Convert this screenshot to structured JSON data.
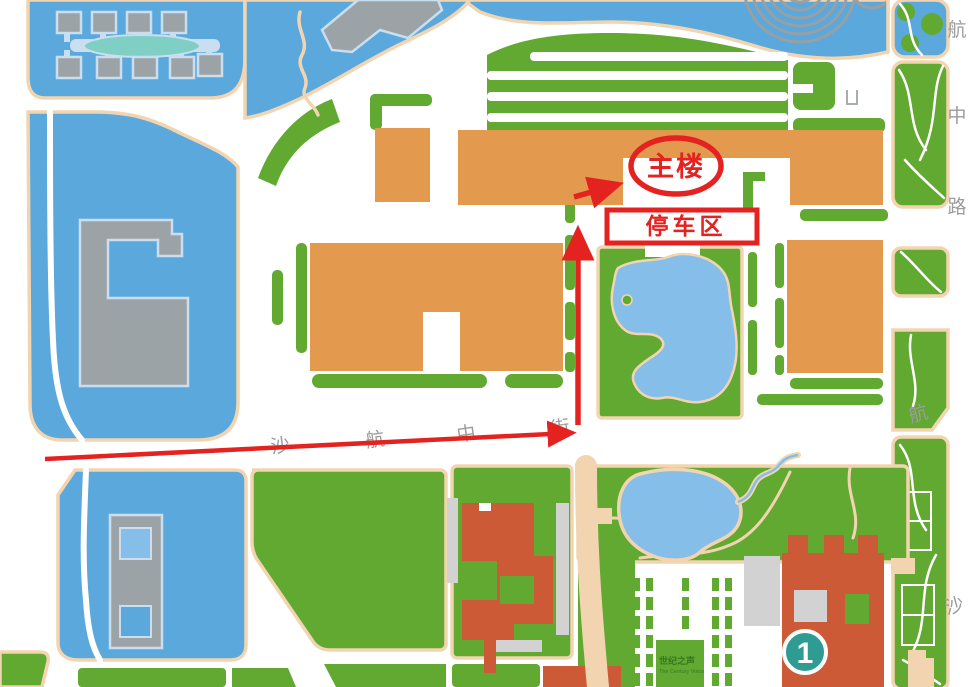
{
  "map": {
    "annotations": {
      "main_building_label": "主楼",
      "parking_area_label": "停车区"
    },
    "road_labels": {
      "shahang_middle_street": [
        "沙",
        "航",
        "中",
        "街"
      ],
      "hangzhong_road": [
        "航",
        "中",
        "路"
      ],
      "southeast_road": [
        "航",
        "沙"
      ]
    },
    "building_marker": "1",
    "watermark": {
      "title": "世纪之声",
      "subtitle": "The Century Voice"
    },
    "colors": {
      "lawn_green": "#61A930",
      "building_orange": "#E39A4F",
      "water_blue": "#5AA8DC",
      "pond_blue": "#85BEE8",
      "pool_teal": "#7FCFC5",
      "building_gray": "#9CA3A6",
      "building_outline_blue": "#C9DFF0",
      "road_edge_tan": "#F2D5B0",
      "building_red": "#CC5A36",
      "annotation_red": "#E42320",
      "marker_teal": "#2E9C92",
      "label_gray": "#9C9C9C",
      "shadow_gray": "#D2D2D2"
    }
  }
}
